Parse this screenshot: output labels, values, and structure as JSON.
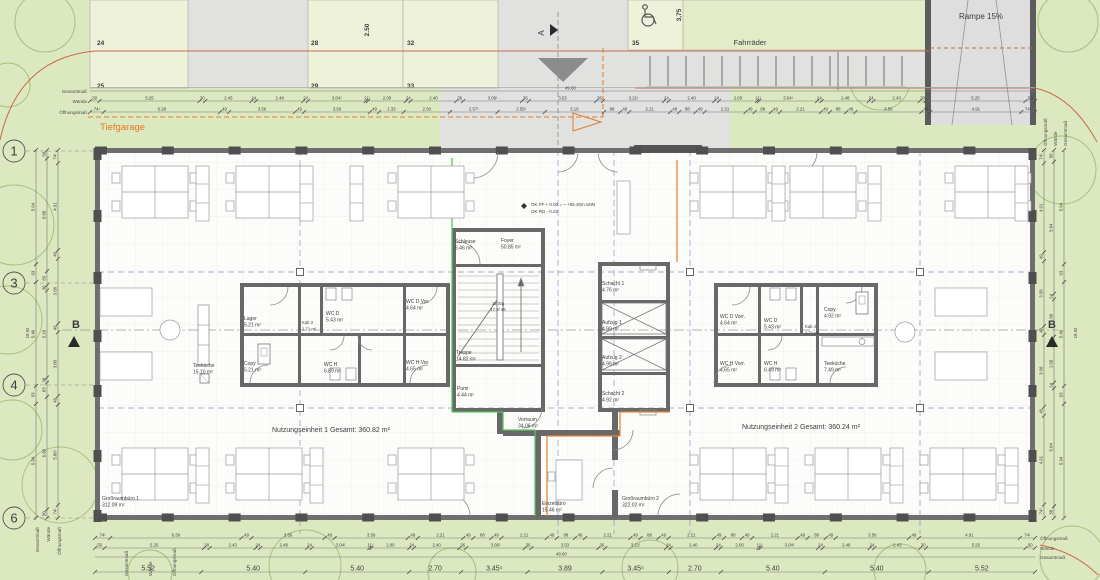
{
  "site": {
    "tiefgarage": "Tiefgarage",
    "fahrraeder": "Fahrräder",
    "rampe": "Rampe 15%",
    "dim_250": "2.50",
    "dim_375": "3,75",
    "parking_upper": [
      "24",
      "28",
      "32",
      "35"
    ],
    "parking_lower": [
      "25",
      "29",
      "33"
    ]
  },
  "markers": {
    "a": "A",
    "b": "B",
    "grid_rows": [
      "1",
      "3",
      "4",
      "6"
    ]
  },
  "level": {
    "line1": "OK FF + 0.00 = ~ +55.30m üNN",
    "line2": "OK RD - 0.22"
  },
  "rooms": {
    "lager": {
      "name": "Lager",
      "area": "5.21 m²"
    },
    "copy1": {
      "name": "Copy",
      "area": "5.21 m²"
    },
    "kab3": {
      "name": "Kab 3",
      "area": "2.71 m²"
    },
    "wcd1": {
      "name": "WC D",
      "area": "5.43 m²"
    },
    "wcdv1": {
      "name": "WC D Vor.",
      "area": "4.64 m²"
    },
    "wch1": {
      "name": "WC H",
      "area": "6.89 m²"
    },
    "wchv1": {
      "name": "WC H Vor.",
      "area": "4.65 m²"
    },
    "teekueche1": {
      "name": "Teeküche",
      "area": "15.10 m²"
    },
    "schleuse": {
      "name": "Schleuse",
      "area": "6.46 m²"
    },
    "foyer": {
      "name": "Foyer",
      "area": "50.85 m²"
    },
    "treppe": {
      "name": "Treppe",
      "area": "14.82 m²"
    },
    "stg": {
      "line1": "18 Stg",
      "line2": "17.9/ 28"
    },
    "pumi": {
      "name": "Pumi",
      "area": "4.44 m²"
    },
    "schacht1": {
      "name": "Schacht 1",
      "area": "4.76 m²"
    },
    "aufzug1": {
      "name": "Aufzug 1",
      "area": "4.99 m²"
    },
    "aufzug2": {
      "name": "Aufzug 2",
      "area": "4.99 m²"
    },
    "schacht2": {
      "name": "Schacht 2",
      "area": "4.92 m²"
    },
    "wcdv2": {
      "name": "WC D Vorr.",
      "area": "4.64 m²"
    },
    "wcd2": {
      "name": "WC D",
      "area": "5.43 m²"
    },
    "kab4": {
      "name": "Kab 4",
      "area": "2.71 m²"
    },
    "copy2": {
      "name": "Copy",
      "area": "4.92 m²"
    },
    "wchv2": {
      "name": "WC H Vorr.",
      "area": "4.65 m²"
    },
    "wch2": {
      "name": "WC H",
      "area": "6.49 m²"
    },
    "teekueche2": {
      "name": "Teeküche",
      "area": "7.49 m²"
    },
    "vorraum": {
      "name": "Vorraum",
      "area": "34.06 m²"
    },
    "einzelbuero": {
      "name": "Einzelbüro",
      "area": "15.46 m²"
    },
    "grossraum1": {
      "name": "Großraumbüro 1",
      "area": "312.09 m²"
    },
    "grossraum2": {
      "name": "Großraumbüro 2",
      "area": "322.02 m²"
    },
    "ne1": "Nutzungseinheit 1 Gesamt: 360.82 m²",
    "ne2": "Nutzungseinheit 2 Gesamt: 360.24 m²"
  },
  "dim_labels": {
    "gesamt": "Gesamtmaß",
    "waende": "Wände",
    "oeffnung": "Öffnungsmaß"
  },
  "dims": {
    "total": "49.60",
    "total_lr": "19.92",
    "top_waende": [
      "50",
      "5.25",
      "30",
      "2.43",
      "24",
      "2.48",
      "24",
      "3.04¹",
      "11¹",
      "2.00",
      "24",
      "2.40",
      "36",
      "3.09¹",
      "36",
      "3.53",
      "36",
      "3.21¹",
      "24",
      "2.40",
      "24",
      "2.00",
      "11¹",
      "3.04¹",
      "24",
      "2.48",
      "24",
      "2.43",
      "30",
      "5.25",
      "50"
    ],
    "top_oeffnung": [
      "74¹",
      "6.28",
      "49",
      "3.56",
      "49",
      "3.56",
      "49",
      "1.33",
      "2.50",
      "2.57¹",
      "2.55¹",
      "3.19",
      "88",
      "49",
      "2.21",
      "49",
      "88",
      "49",
      "2.21",
      "49",
      "88",
      "49",
      "2.21",
      "49",
      "88",
      "49",
      "3.56",
      "49",
      "4.91",
      "74¹"
    ],
    "bottom_oeffnung": [
      "74¹",
      "6.39",
      "49",
      "3.56",
      "49",
      "3.56",
      "49",
      "2.21",
      "49",
      "88",
      "49",
      "2.21",
      "49",
      "88",
      "49",
      "2.21",
      "49",
      "88",
      "49",
      "2.21",
      "49",
      "88",
      "49",
      "2.21",
      "49",
      "88",
      "49",
      "3.56",
      "49",
      "4.91",
      "74¹"
    ],
    "bottom_waende": [
      "50",
      "5.25",
      "30",
      "2.43",
      "24",
      "2.48",
      "24",
      "3.04¹",
      "11¹",
      "2.00",
      "24",
      "2.40",
      "36",
      "3.09¹",
      "36",
      "3.53",
      "36",
      "3.21¹",
      "24",
      "2.40",
      "24",
      "2.00",
      "11¹",
      "3.04¹",
      "24",
      "2.48",
      "24",
      "2.43",
      "30",
      "5.25",
      "50"
    ],
    "bottom_totals": [
      "5.52",
      "5.40",
      "5.40",
      "2.70",
      "3.45⁵",
      "3.89",
      "3.45⁵",
      "2.70",
      "5.40",
      "5.40",
      "5.52"
    ],
    "left_gesamt": [
      "5.94",
      "93",
      "5.40",
      "93",
      "5.94"
    ],
    "left_waende": [
      "50",
      "6.60",
      "83",
      "30",
      "5.10",
      "30",
      "83",
      "6.60",
      "50"
    ],
    "left_oeffnung": [
      "74¹",
      "4.91",
      "49",
      "3.66",
      "49",
      "3.60",
      "49",
      "5.66¹",
      "74¹"
    ],
    "right_gesamt": [
      "5.94",
      "93",
      "5.40",
      "93",
      "5.94"
    ],
    "right_waende": [
      "50",
      "5.64",
      "24",
      "1.60",
      "36",
      "1.60",
      "24",
      "5.04",
      "50"
    ],
    "right_oeffnung": [
      "74¹",
      "4.91",
      "49",
      "3.58",
      "49",
      "3.98",
      "49",
      "4.91",
      "74¹"
    ]
  },
  "colors": {
    "site_green": "#dce8c0",
    "stall_pale": "#eef2da",
    "bike_green": "#e2ecc8",
    "asphalt": "#e1e1e0",
    "floor": "#fcfcfa",
    "wall": "#6e6e6e",
    "axis_blue": "#9090c0",
    "accent_green": "#58c558",
    "accent_orange": "#e8883a",
    "boundary_red": "#c96a4a",
    "garage_orange": "#e07a28"
  }
}
